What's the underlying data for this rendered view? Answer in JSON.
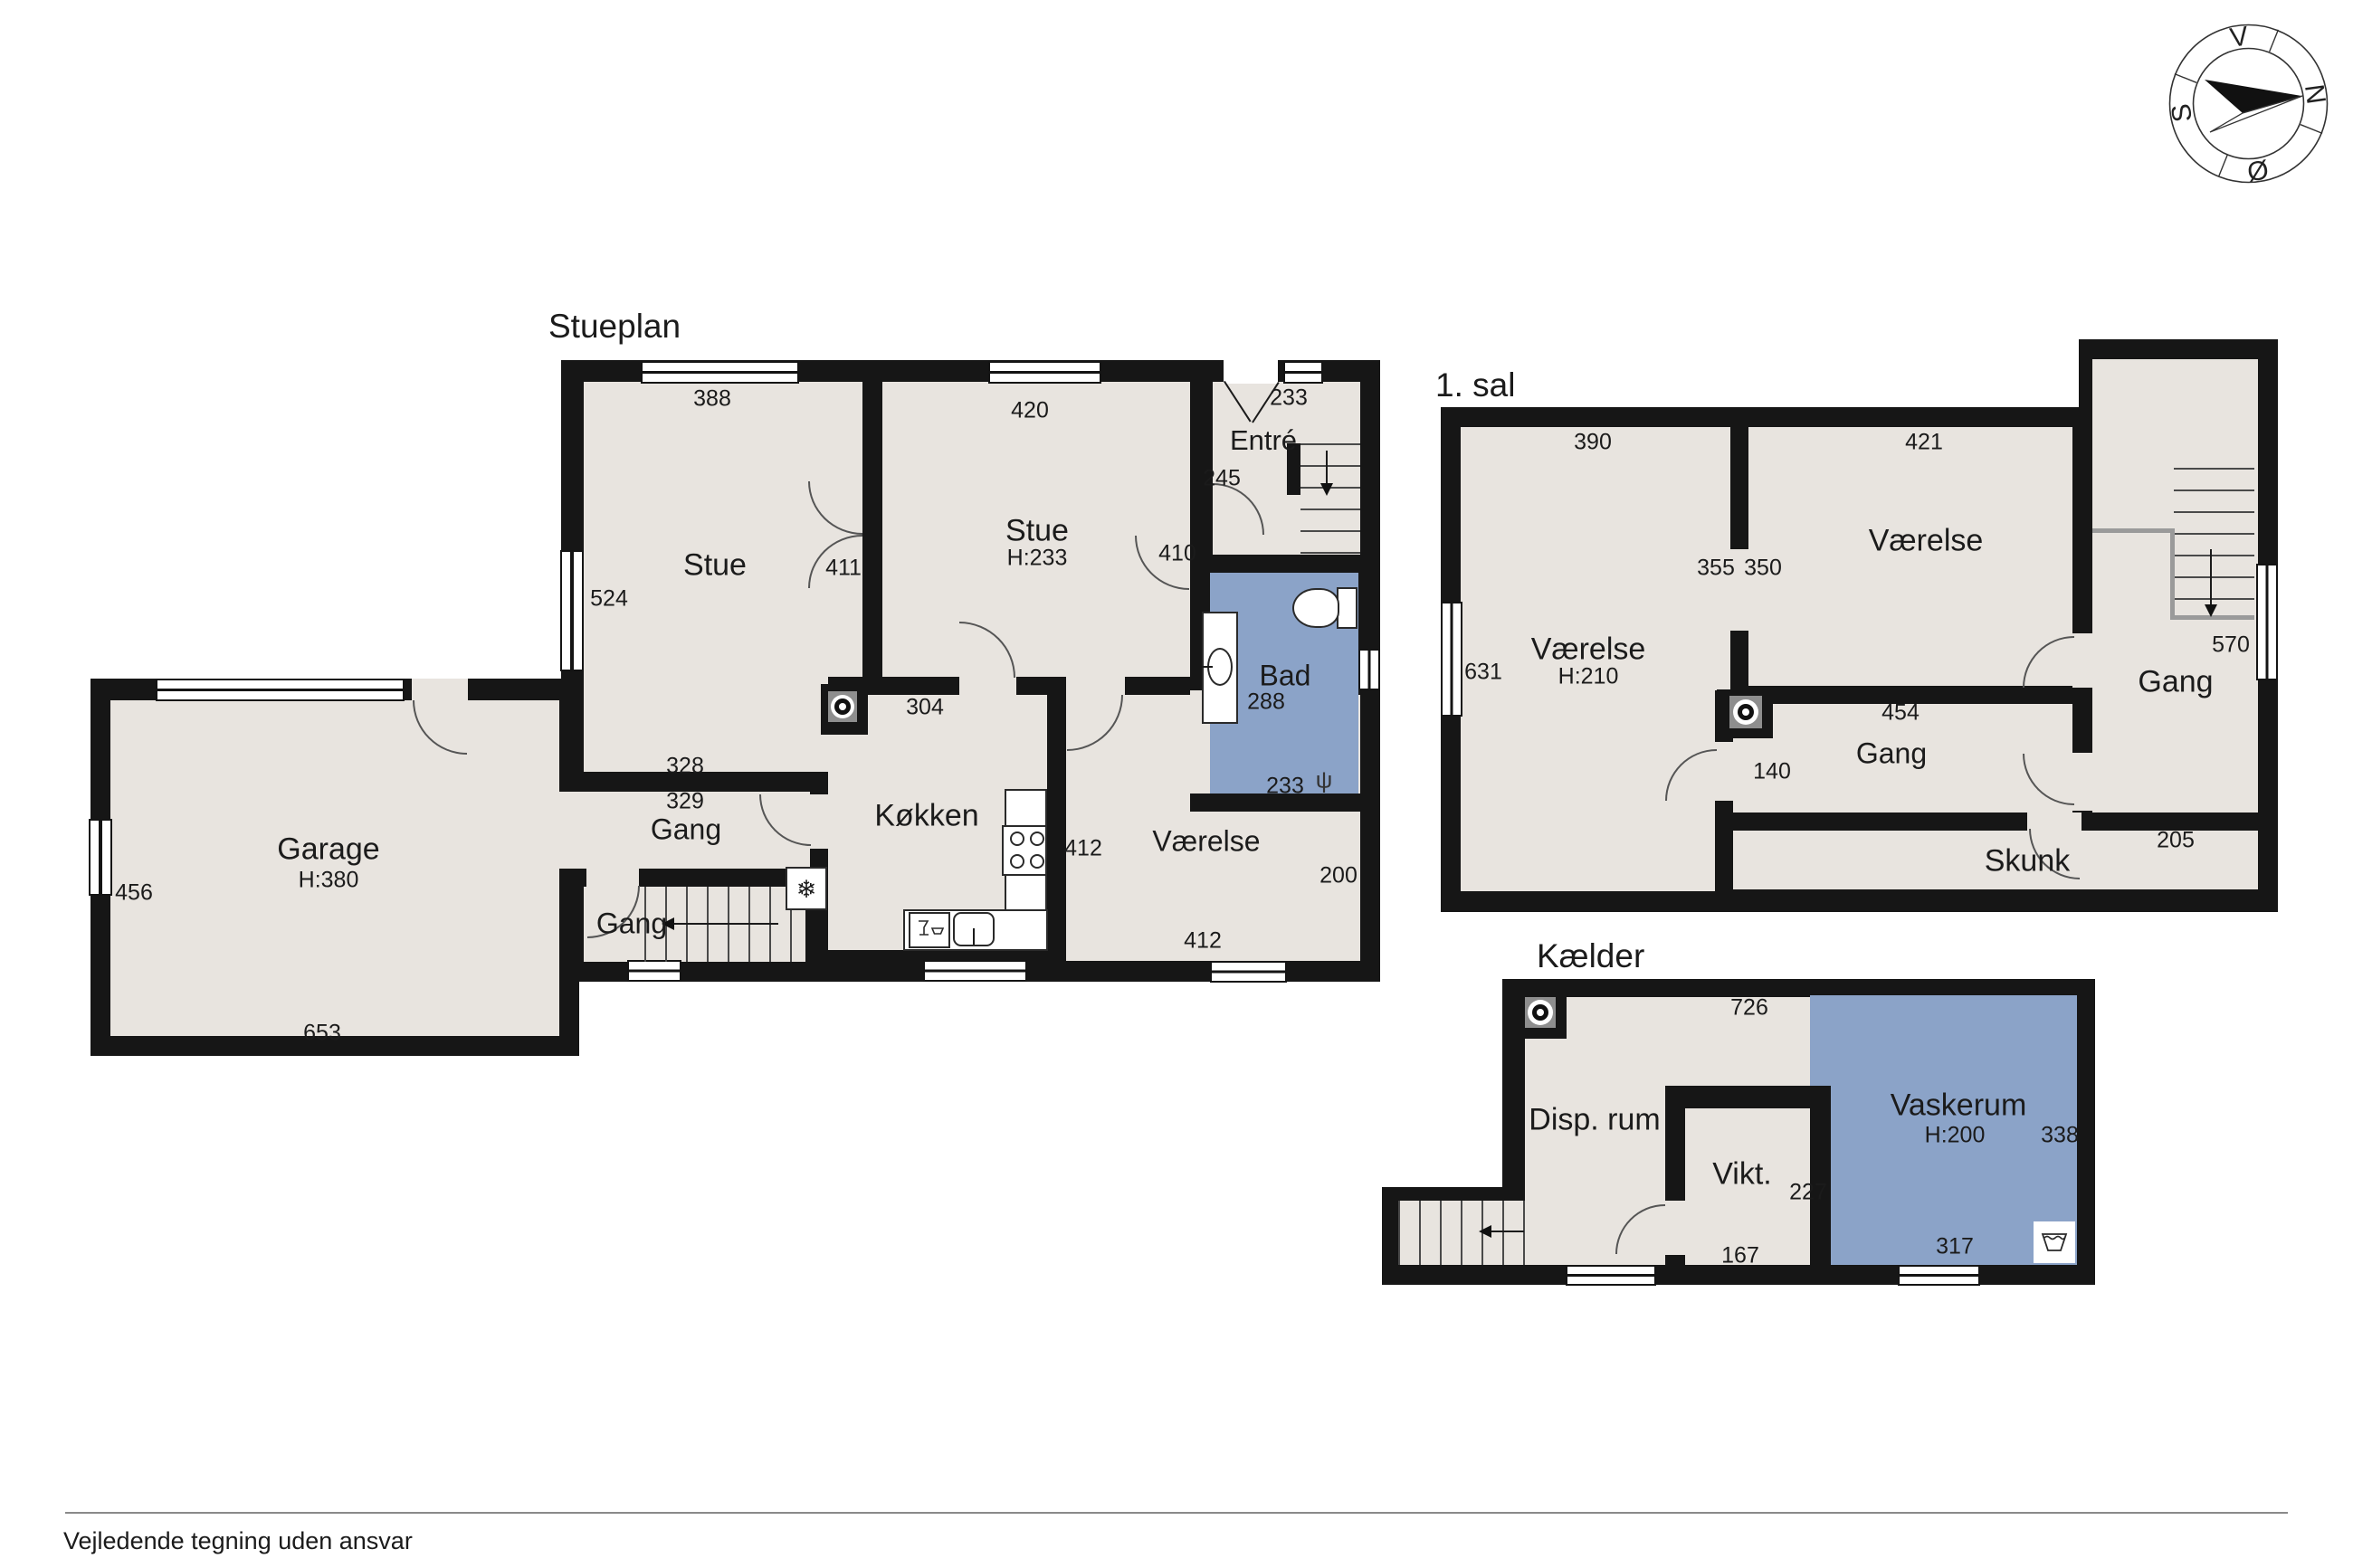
{
  "titles": {
    "ground": "Stueplan",
    "first": "1. sal",
    "basement": "Kælder"
  },
  "footer": "Vejledende tegning uden ansvar",
  "compass": {
    "north": "N",
    "south": "S",
    "east": "Ø",
    "west": "V"
  },
  "colors": {
    "wall": "#161616",
    "room": "#E8E4DF",
    "wet_room": "#8BA3C8"
  },
  "ground": {
    "stue1": {
      "label": "Stue",
      "dim_top": "388",
      "dim_left": "524",
      "dim_bottom": "328",
      "door": "411"
    },
    "stue2": {
      "label": "Stue",
      "height": "H:233",
      "dim_top": "420",
      "door_right": "410"
    },
    "entre": {
      "label": "Entré",
      "dim_top": "233",
      "dim_left": "245"
    },
    "bad": {
      "label": "Bad",
      "dim": "288",
      "dim_bottom": "233"
    },
    "koekken": {
      "label": "Køkken",
      "dim_top": "304"
    },
    "gang_top": {
      "label": "Gang",
      "dim_top": "329"
    },
    "gang_stairs": {
      "label": "Gang"
    },
    "vaerelse": {
      "label": "Værelse",
      "dim_left": "412",
      "dim_right": "200",
      "dim_bottom": "412"
    },
    "garage": {
      "label": "Garage",
      "height": "H:380",
      "dim_left": "456",
      "dim_bottom": "653"
    }
  },
  "first": {
    "vaerelse_left": {
      "label": "Værelse",
      "height": "H:210",
      "dim_top": "390",
      "dim_left": "631",
      "dim_mid": "355"
    },
    "vaerelse_right": {
      "label": "Værelse",
      "dim_top": "421",
      "dim_mid": "350"
    },
    "gang": {
      "label": "Gang",
      "dim_top": "454",
      "dim_left": "140"
    },
    "hall": {
      "label": "Gang",
      "dim": "570"
    },
    "skunk": {
      "label": "Skunk",
      "dim_right": "205"
    }
  },
  "basement": {
    "disp": {
      "label": "Disp. rum",
      "dim_top": "726"
    },
    "vikt": {
      "label": "Vikt.",
      "dim_right": "227",
      "dim_bottom": "167"
    },
    "vaskerum": {
      "label": "Vaskerum",
      "height": "H:200",
      "dim_right": "338",
      "dim_bottom": "317"
    }
  }
}
